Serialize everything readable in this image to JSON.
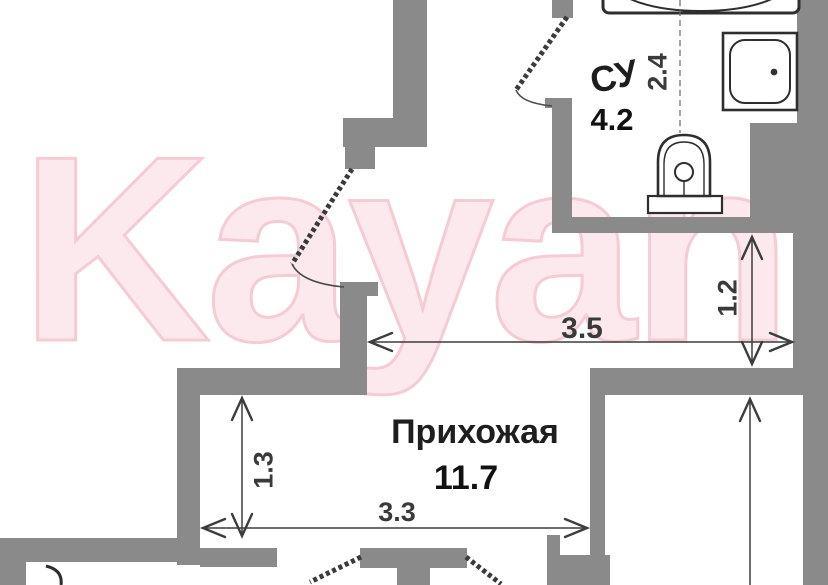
{
  "watermark": {
    "text": "Kayan",
    "fill_color": "#fbe9ed",
    "outline_color": "#f5cbd4"
  },
  "rooms": {
    "bathroom": {
      "name": "СУ",
      "area": "4.2"
    },
    "hallway": {
      "name": "Прихожая",
      "area": "11.7"
    }
  },
  "dimensions": {
    "bathroom_width": "2.4",
    "niche_height": "1.2",
    "corridor_width": "3.5",
    "hallway_left_height": "1.3",
    "hallway_bottom_width": "3.3"
  },
  "fixtures": {
    "bathtub": "bathtub",
    "shower": "shower-cabin",
    "toilet": "toilet"
  },
  "colors": {
    "wall": "#8a8a8a",
    "line": "#3d3d3d",
    "background": "#ffffff",
    "room_text": "#1e1e1e",
    "watermark_pink": "#f5cbd4"
  }
}
